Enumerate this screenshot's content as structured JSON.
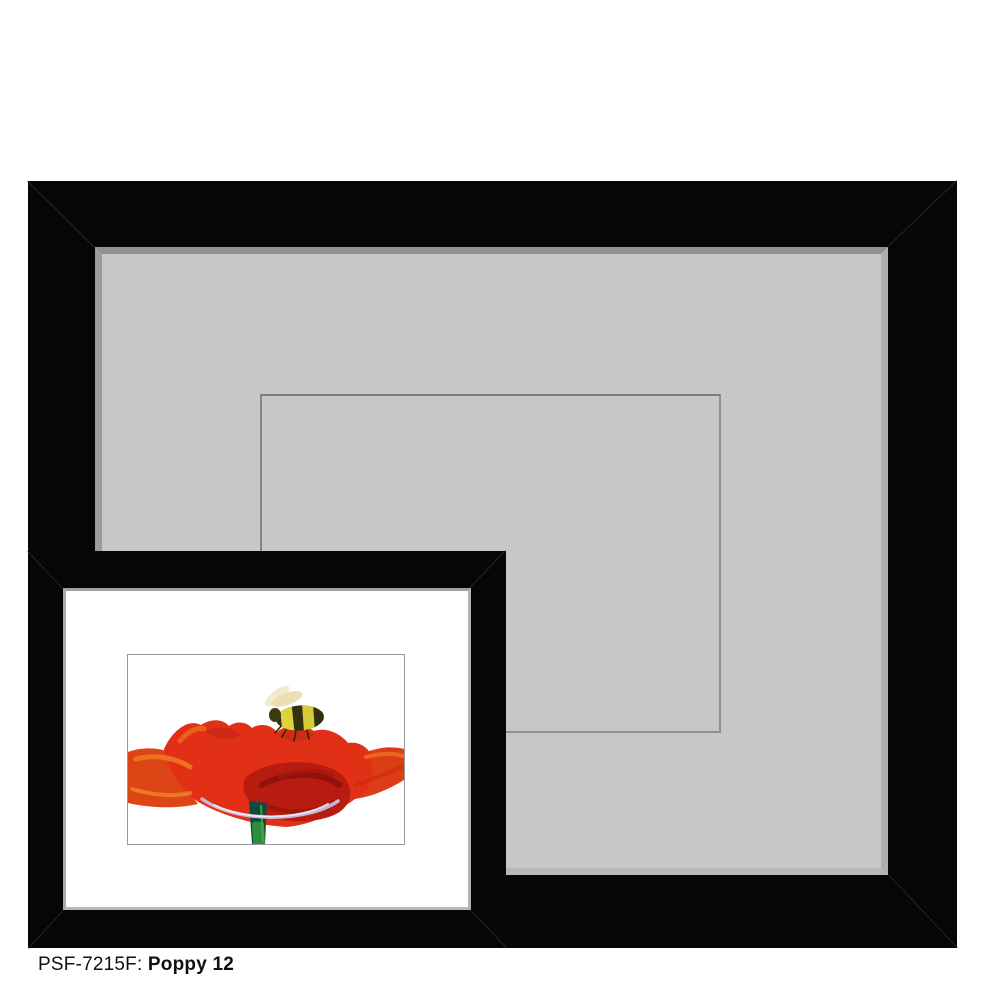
{
  "caption": {
    "sku": "PSF-7215F:",
    "title": "Poppy 12"
  },
  "mockup": {
    "large_frame": {
      "label": "black frame with gray mat and empty opening outline"
    },
    "overlay_frame": {
      "label": "black frame with white mat and framed print"
    },
    "artwork": {
      "title": "Poppy 12",
      "subject": "red poppy flower with bumblebee"
    }
  },
  "colors": {
    "frame_black": "#060606",
    "mat_gray": "#c6c7c9",
    "mat_bevel": "#9b9c9e",
    "window_line": "#85878a",
    "small_mat_white": "#ffffff",
    "caption_text": "#111111",
    "poppy_red": "#e23017",
    "poppy_deep_red": "#b81b10",
    "poppy_orange": "#ea671c",
    "stem_teal": "#10493f",
    "stem_green": "#2e9440",
    "bee_yellow": "#dcd23b",
    "bee_dark": "#31310f",
    "bee_wing": "#f0e9ca",
    "petal_lavender": "#c9bedb"
  }
}
